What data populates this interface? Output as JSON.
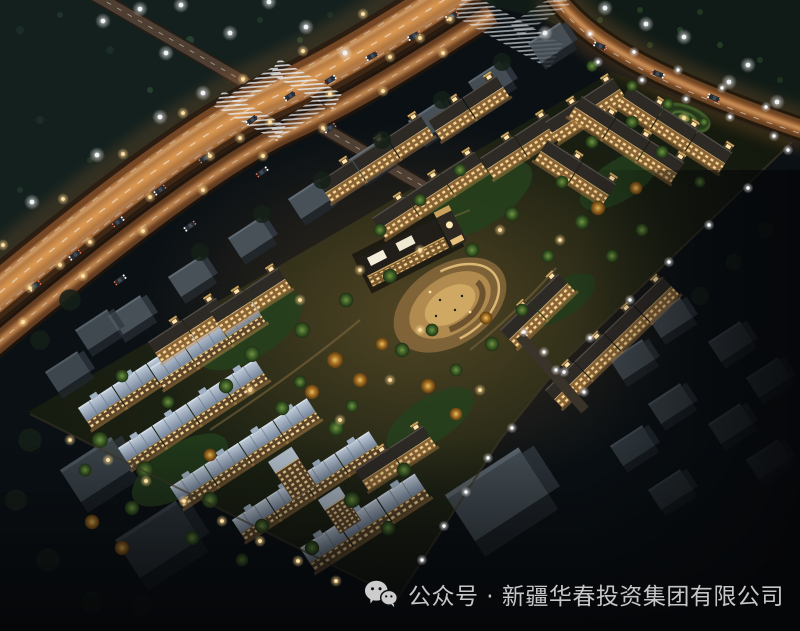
{
  "caption": {
    "icon": "wechat-icon",
    "text": "公众号 · 新疆华春投资集团有限公司"
  },
  "scene": {
    "type": "aerial-night-rendering",
    "subject": "bird's-eye night view of a low-rise residential development with illuminated highway",
    "landmarks": [
      "main-highway",
      "cross-street",
      "boundary-road",
      "intersection-crosswalks",
      "street-lamps",
      "cars",
      "unlit-context-buildings",
      "lit-townhouse-rows",
      "central-clubhouse-plaza",
      "spiral-garden",
      "perimeter-wall-lamps",
      "trees"
    ]
  },
  "colors": {
    "background": "#07090b",
    "vegetation_dark": "#14211d",
    "road_surface": "#7a4a26",
    "road_glow": "#c77b38",
    "road_glow_bright": "#ffd9a0",
    "crosswalk": "#e8edf2",
    "building_unlit": "#4e585f",
    "roof_blue": "#a9b7c6",
    "roof_dark": "#2d2925",
    "facade_lit": "#8a6436",
    "window_glow": "#ffdf9b",
    "tree_green": "#49682c",
    "tree_autumn": "#cf9a3a",
    "plaza_paving": "#b08a4e",
    "lamp_white": "#f8fbff",
    "lamp_warm": "#ffe2a8",
    "caption_text": "#c7c7c7"
  }
}
